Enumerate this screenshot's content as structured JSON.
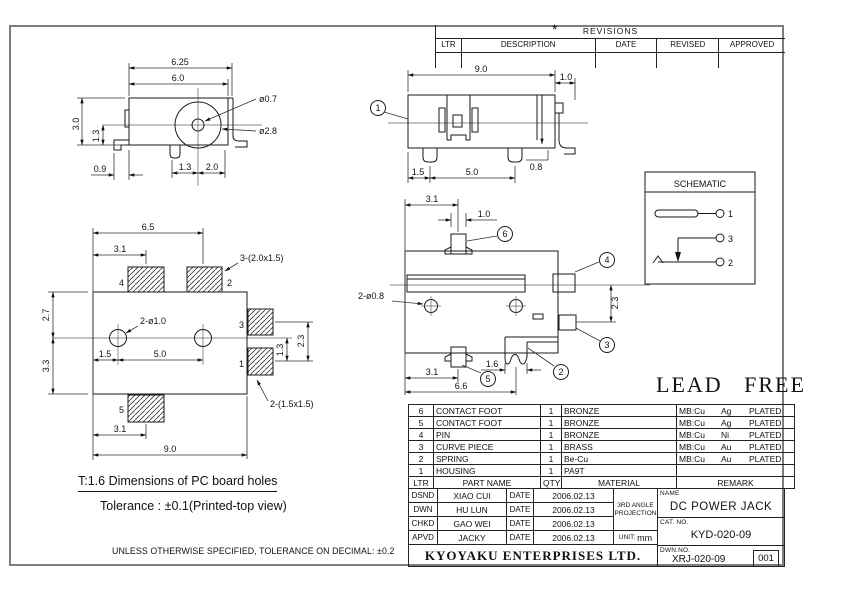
{
  "revisions": {
    "star": "*",
    "title": "REVISIONS",
    "columns": [
      "LTR",
      "DESCRIPTION",
      "DATE",
      "REVISED",
      "APPROVED"
    ]
  },
  "views": {
    "front": {
      "dim_w_outer": "6.25",
      "dim_w_body": "6.0",
      "dim_h_body": "3.0",
      "dim_h_lower": "1.3",
      "dim_foot": "0.9",
      "dim_pin_left": "1.3",
      "dim_pin_right": "2.0",
      "dim_hole_small": "ø0.7",
      "dim_hole_large": "ø2.8"
    },
    "side": {
      "balloon_1": "1",
      "dim_width": "9.0",
      "dim_flange": "1.0",
      "dim_slot": "0.8",
      "dim_foot_offset": "1.5",
      "dim_foot_pitch": "5.0"
    },
    "bottom": {
      "balloon_6": "6",
      "balloon_4": "4",
      "balloon_3": "3",
      "balloon_2": "2",
      "balloon_5": "5",
      "dim_tab_offset": "3.1",
      "dim_tab_width": "1.0",
      "label_holes": "2-ø0.8",
      "dim_side": "2.3",
      "dim_spring": "1.6",
      "dim_foot5_offset": "3.1",
      "dim_total": "6.6"
    },
    "pcb": {
      "pad_4": "4",
      "pad_2": "2",
      "pad_3": "3",
      "pad_1": "1",
      "pad_5": "5",
      "dim_pad2": "6.5",
      "dim_pad4": "3.1",
      "label_top_pads": "3-(2.0x1.5)",
      "dim_upper": "2.7",
      "dim_lower": "3.3",
      "label_holes": "2-ø1.0",
      "dim_hole_offset": "1.5",
      "dim_hole_pitch": "5.0",
      "dim_pad1": "1.3",
      "dim_pad13_pitch": "2.3",
      "label_right_pads": "2-(1.5x1.5)",
      "dim_pad5": "3.1",
      "dim_total": "9.0"
    }
  },
  "schematic": {
    "title": "SCHEMATIC",
    "pin_1": "1",
    "pin_3": "3",
    "pin_2": "2"
  },
  "lead_free": "LEAD FREE",
  "parts": {
    "header": {
      "ltr": "LTR",
      "name": "PART NAME",
      "qty": "QTY",
      "material": "MATERIAL",
      "remark": "REMARK"
    },
    "rows": [
      {
        "ltr": "6",
        "name": "CONTACT FOOT",
        "qty": "1",
        "material": "BRONZE",
        "mb": "MB:Cu",
        "plate": "Ag",
        "plated": "PLATED"
      },
      {
        "ltr": "5",
        "name": "CONTACT FOOT",
        "qty": "1",
        "material": "BRONZE",
        "mb": "MB:Cu",
        "plate": "Ag",
        "plated": "PLATED"
      },
      {
        "ltr": "4",
        "name": "PIN",
        "qty": "1",
        "material": "BRONZE",
        "mb": "MB:Cu",
        "plate": "Ni",
        "plated": "PLATED"
      },
      {
        "ltr": "3",
        "name": "CURVE PIECE",
        "qty": "1",
        "material": "BRASS",
        "mb": "MB:Cu",
        "plate": "Au",
        "plated": "PLATED"
      },
      {
        "ltr": "2",
        "name": "SPRING",
        "qty": "1",
        "material": "Be-Cu",
        "mb": "MB:Cu",
        "plate": "Au",
        "plated": "PLATED"
      },
      {
        "ltr": "1",
        "name": "HOUSING",
        "qty": "1",
        "material": "PA9T",
        "mb": "",
        "plate": "",
        "plated": ""
      }
    ]
  },
  "title_block": {
    "approvals": [
      {
        "role": "DSND",
        "person": "XIAO CUI",
        "date_label": "DATE",
        "date": "2006.02.13"
      },
      {
        "role": "DWN",
        "person": "HU LUN",
        "date_label": "DATE",
        "date": "2006.02.13"
      },
      {
        "role": "CHKD",
        "person": "GAO WEI",
        "date_label": "DATE",
        "date": "2006.02.13"
      },
      {
        "role": "APVD",
        "person": "JACKY",
        "date_label": "DATE",
        "date": "2006.02.13"
      }
    ],
    "projection_line1": "3RD ANGLE",
    "projection_line2": "PROJECTION",
    "unit_label": "UNIT:",
    "unit_value": "mm",
    "name_label": "NAME",
    "part_name": "DC POWER JACK",
    "cat_label": "CAT. NO.",
    "cat_no": "KYD-020-09",
    "dwn_label": "DWN.NO.",
    "dwn_no": "XRJ-020-09",
    "sheet_no": "001",
    "company": "KYOYAKU ENTERPRISES LTD."
  },
  "notes": {
    "pcb_note": "T:1.6 Dimensions of PC board holes",
    "tolerance_note": "Tolerance : ±0.1(Printed-top view)",
    "general_note": "UNLESS OTHERWISE SPECIFIED, TOLERANCE ON DECIMAL: ±0.2"
  }
}
